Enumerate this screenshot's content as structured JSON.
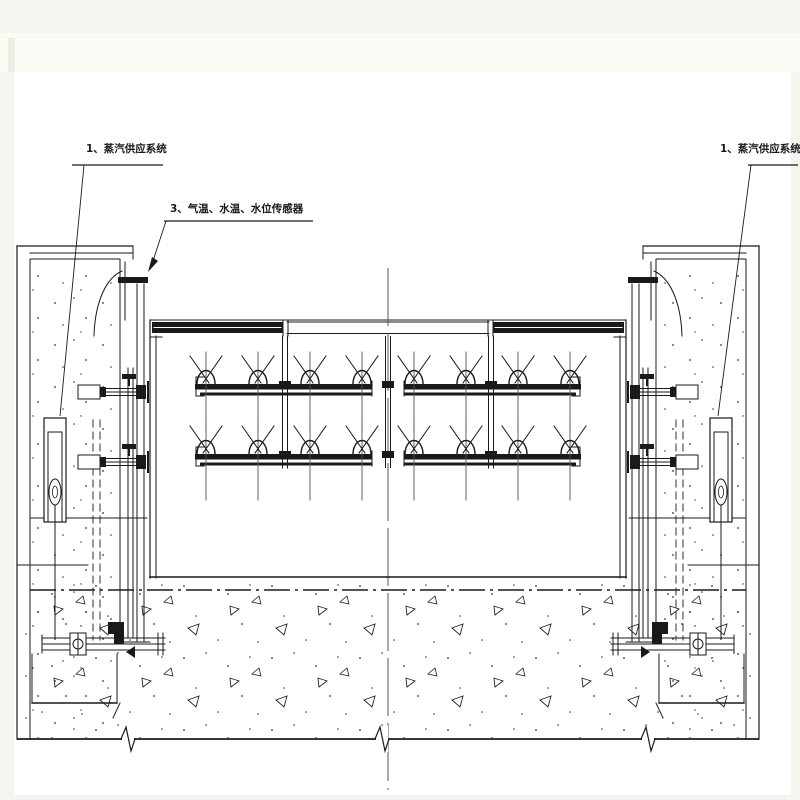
{
  "labels": {
    "steam_system_left": "1、蒸汽供应系统",
    "sensors": "3、气温、水温、水位传感器",
    "steam_system_right": "1、蒸汽供应系统"
  },
  "colors": {
    "ink": "#1a1a1a",
    "page_tint": "#f3f6ee",
    "top_band": "#f9fbf4",
    "sheet_white": "#ffffff",
    "centerline_gray": "#555555"
  },
  "drawing": {
    "kind": "technical elevation drawing",
    "features": [
      "left concrete pier",
      "right concrete pier",
      "gate with steam spray nozzles (4 rails x 4 nozzles)",
      "steam supply units in both piers",
      "bottom pipes with valves",
      "concrete base with aggregate hatch",
      "vertical centerline",
      "ground break line"
    ]
  }
}
